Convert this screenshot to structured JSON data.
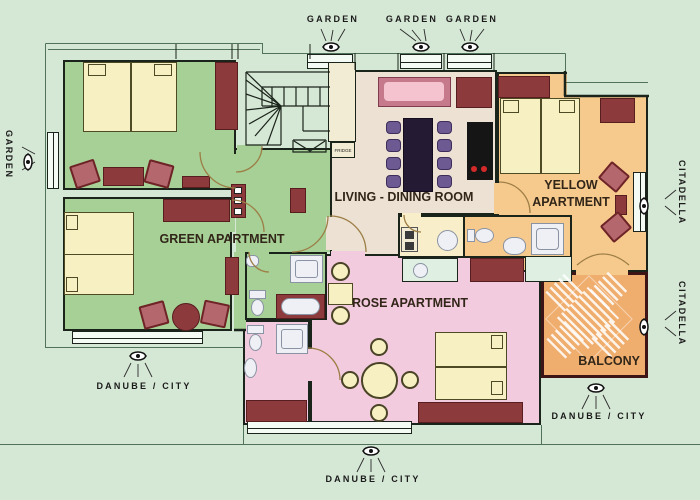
{
  "labels": {
    "garden_top": [
      "GARDEN",
      "GARDEN",
      "GARDEN"
    ],
    "garden_left": "GARDEN",
    "citadella": [
      "CITADELLA",
      "CITADELLA"
    ],
    "danube": [
      "DANUBE / CITY",
      "DANUBE / CITY",
      "DANUBE / CITY"
    ]
  },
  "rooms": {
    "green": "GREEN APARTMENT",
    "living": "LIVING - DINING ROOM",
    "yellow": [
      "YELLOW",
      "APARTMENT"
    ],
    "rose": "ROSE APARTMENT",
    "balcony": "BALCONY",
    "fridge": "FRIDGE"
  },
  "colors": {
    "background": "#d5e7d5",
    "wall": "#1b241b",
    "green_floor": "#a7d096",
    "living_floor": "#ece1d3",
    "yellow_floor": "#f6c98d",
    "rose_floor": "#f3cbdf",
    "balcony_floor": "#f0ae6e",
    "furniture_red": "#8d3a3c",
    "chair_red": "#b4686d",
    "bed_cream": "#f7f0c2",
    "chair_purple": "#6e5a92",
    "dining_table": "#241a33",
    "sofa_pink": "#f4c3cf"
  }
}
